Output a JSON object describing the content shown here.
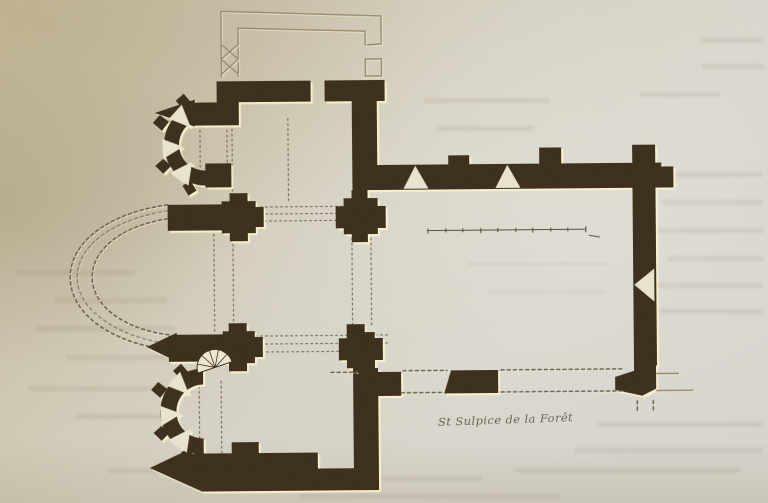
{
  "figure": {
    "caption": "St Sulpice de la Forêt",
    "drawing_type": "church floor plan",
    "ruined_parts_shown_dashed": "main apse and south nave wall",
    "annex_shown_in_outline": "north sacristy"
  },
  "colors": {
    "paper": "#d3cdbd",
    "paper_dark": "#c7bc9f",
    "paper_light": "#dbd8d0",
    "wall": "#3c2f1d",
    "wall_highlight": "#fdf3cd",
    "line_thin": "#968a6e",
    "line_dash": "#6e6351",
    "ink": "#59503f",
    "splay": "#e9e3d0"
  }
}
